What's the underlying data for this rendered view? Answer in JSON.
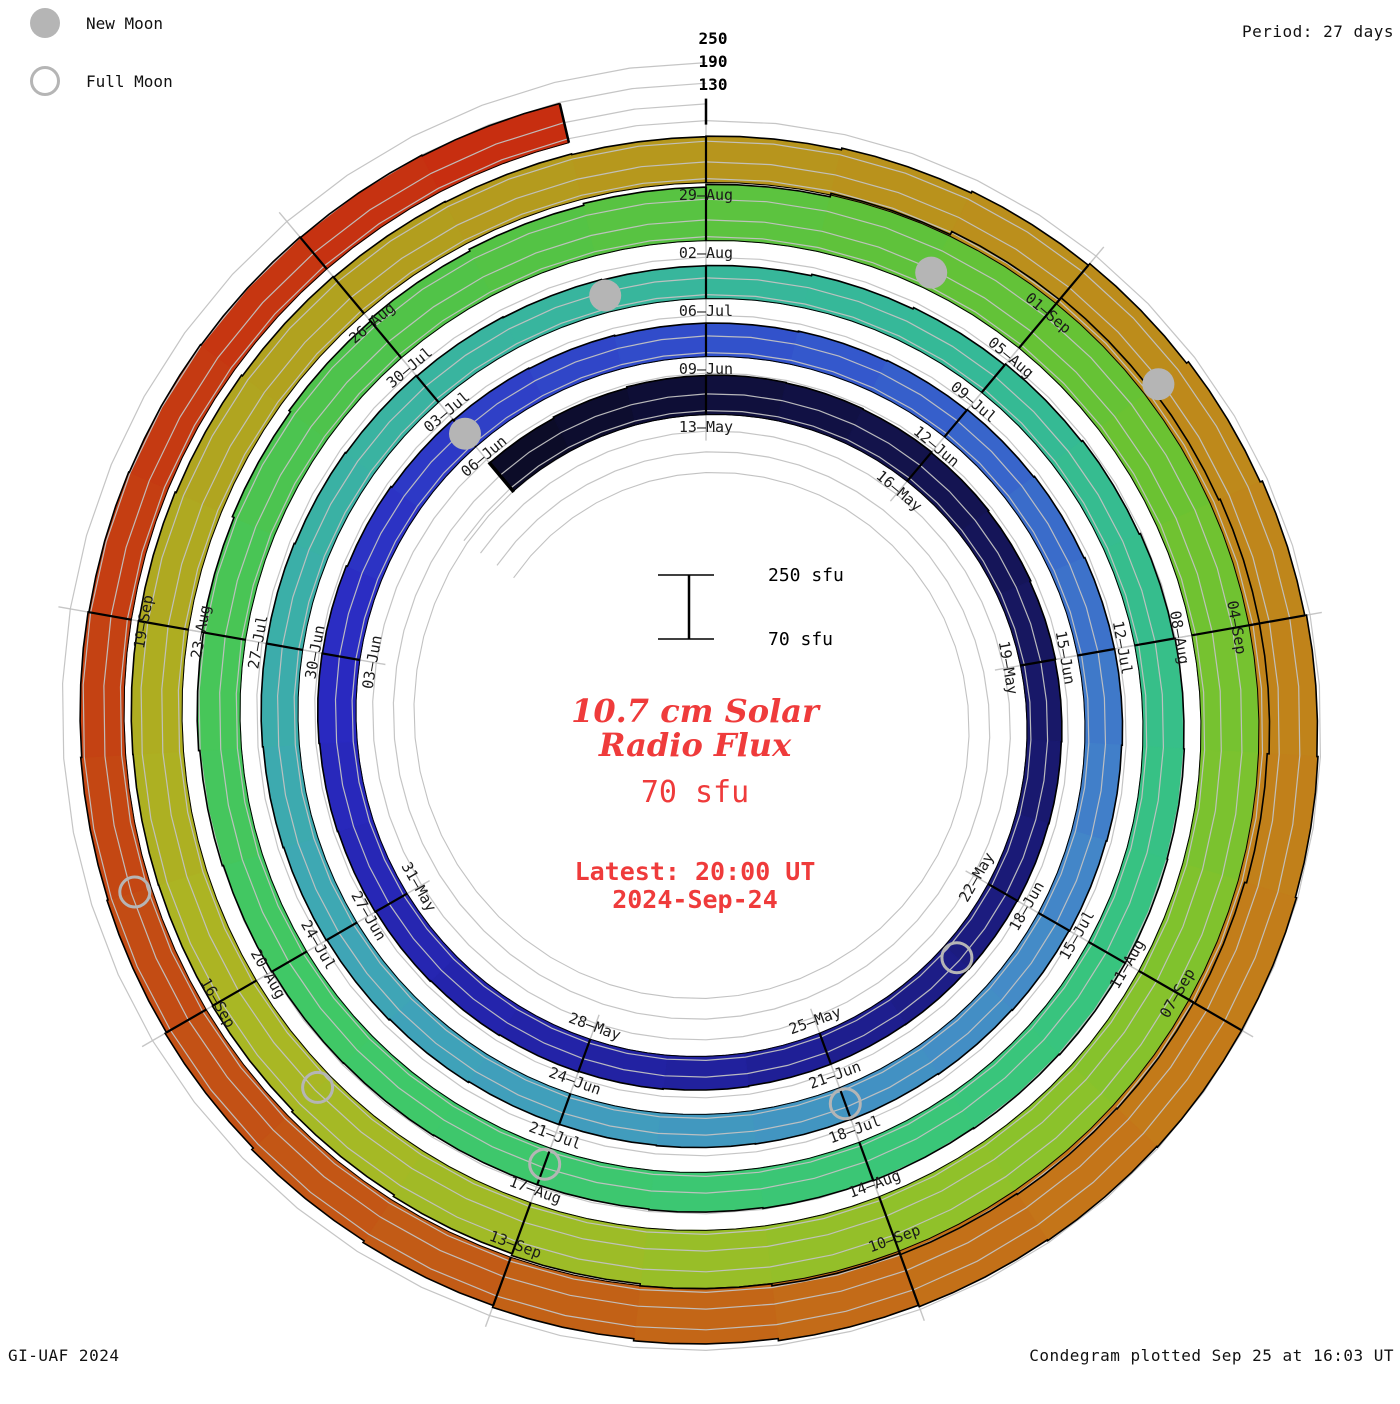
{
  "header": {
    "period": "Period: 27 days"
  },
  "legend": {
    "new_moon": "New Moon",
    "full_moon": "Full Moon"
  },
  "footer": {
    "left": "GI-UAF 2024",
    "right": "Condegram plotted Sep 25 at 16:03 UT"
  },
  "center": {
    "scale_top": "250 sfu",
    "scale_bottom": "70 sfu",
    "title_line1": "10.7 cm Solar",
    "title_line2": "Radio Flux",
    "current_flux": "70 sfu",
    "latest_line1": "Latest: 20:00 UT",
    "latest_line2": "2024-Sep-24",
    "accent_color": "#ef3b3b"
  },
  "chart_data": {
    "type": "bar",
    "layout": "polar_spiral_condegram",
    "title": "10.7 cm Solar Radio Flux",
    "ylabel": "solar flux (sfu)",
    "units": "sfu",
    "period_days_per_rotation": 27,
    "spiral_start_date": "2024-05-10",
    "first_label_date_at_top": "2024-05-13",
    "baseline_sfu": 70,
    "radial_ticks_sfu": [
      130,
      190,
      250
    ],
    "ylim": [
      70,
      250
    ],
    "points": [
      {
        "date": "2024-05-10",
        "flux": 175,
        "label": null
      },
      {
        "date": "2024-05-13",
        "flux": 185,
        "label": "13–May"
      },
      {
        "date": "2024-05-16",
        "flux": 180,
        "label": "16–May"
      },
      {
        "date": "2024-05-19",
        "flux": 172,
        "label": "19–May"
      },
      {
        "date": "2024-05-22",
        "flux": 168,
        "label": "22–May"
      },
      {
        "date": "2024-05-25",
        "flux": 165,
        "label": "25–May"
      },
      {
        "date": "2024-05-28",
        "flux": 170,
        "label": "28–May"
      },
      {
        "date": "2024-05-31",
        "flux": 176,
        "label": "31–May"
      },
      {
        "date": "2024-06-03",
        "flux": 182,
        "label": "03–Jun"
      },
      {
        "date": "2024-06-06",
        "flux": 172,
        "label": "06–Jun"
      },
      {
        "date": "2024-06-09",
        "flux": 166,
        "label": "09–Jun"
      },
      {
        "date": "2024-06-12",
        "flux": 172,
        "label": "12–Jun"
      },
      {
        "date": "2024-06-15",
        "flux": 180,
        "label": "15–Jun"
      },
      {
        "date": "2024-06-18",
        "flux": 174,
        "label": "18–Jun"
      },
      {
        "date": "2024-06-21",
        "flux": 168,
        "label": "21–Jun"
      },
      {
        "date": "2024-06-24",
        "flux": 164,
        "label": "24–Jun"
      },
      {
        "date": "2024-06-27",
        "flux": 172,
        "label": "27–Jun"
      },
      {
        "date": "2024-06-30",
        "flux": 178,
        "label": "30–Jun"
      },
      {
        "date": "2024-07-03",
        "flux": 170,
        "label": "03–Jul"
      },
      {
        "date": "2024-07-06",
        "flux": 164,
        "label": "06–Jul"
      },
      {
        "date": "2024-07-09",
        "flux": 176,
        "label": "09–Jul"
      },
      {
        "date": "2024-07-12",
        "flux": 188,
        "label": "12–Jul"
      },
      {
        "date": "2024-07-15",
        "flux": 194,
        "label": "15–Jul"
      },
      {
        "date": "2024-07-18",
        "flux": 188,
        "label": "18–Jul"
      },
      {
        "date": "2024-07-21",
        "flux": 182,
        "label": "21–Jul"
      },
      {
        "date": "2024-07-24",
        "flux": 186,
        "label": "24–Jul"
      },
      {
        "date": "2024-07-27",
        "flux": 196,
        "label": "27–Jul"
      },
      {
        "date": "2024-07-30",
        "flux": 212,
        "label": "30–Jul"
      },
      {
        "date": "2024-08-02",
        "flux": 228,
        "label": "02–Aug"
      },
      {
        "date": "2024-08-05",
        "flux": 258,
        "label": "05–Aug"
      },
      {
        "date": "2024-08-08",
        "flux": 272,
        "label": "08–Aug"
      },
      {
        "date": "2024-08-11",
        "flux": 255,
        "label": "11–Aug"
      },
      {
        "date": "2024-08-14",
        "flux": 248,
        "label": "14–Aug"
      },
      {
        "date": "2024-08-17",
        "flux": 230,
        "label": "17–Aug"
      },
      {
        "date": "2024-08-20",
        "flux": 215,
        "label": "20–Aug"
      },
      {
        "date": "2024-08-23",
        "flux": 218,
        "label": "23–Aug"
      },
      {
        "date": "2024-08-26",
        "flux": 208,
        "label": "26–Aug"
      },
      {
        "date": "2024-08-29",
        "flux": 202,
        "label": "29–Aug"
      },
      {
        "date": "2024-09-01",
        "flux": 218,
        "label": "01–Sep"
      },
      {
        "date": "2024-09-04",
        "flux": 238,
        "label": "04–Sep"
      },
      {
        "date": "2024-09-07",
        "flux": 248,
        "label": "07–Sep"
      },
      {
        "date": "2024-09-10",
        "flux": 240,
        "label": "10–Sep"
      },
      {
        "date": "2024-09-13",
        "flux": 222,
        "label": "13–Sep"
      },
      {
        "date": "2024-09-16",
        "flux": 205,
        "label": "16–Sep"
      },
      {
        "date": "2024-09-19",
        "flux": 196,
        "label": "19–Sep"
      },
      {
        "date": "2024-09-22",
        "flux": 190,
        "label": null
      },
      {
        "date": "2024-09-24",
        "flux": 186,
        "label": null
      }
    ],
    "new_moons": [
      "2024-06-06",
      "2024-07-05",
      "2024-08-04",
      "2024-09-02"
    ],
    "full_moons": [
      "2024-05-23",
      "2024-06-21",
      "2024-07-21",
      "2024-08-19",
      "2024-09-17"
    ],
    "colors": {
      "gradient_day_stops": [
        [
          0,
          "#0b0b24"
        ],
        [
          8,
          "#16165c"
        ],
        [
          16,
          "#20209a"
        ],
        [
          24,
          "#2a2ac2"
        ],
        [
          31,
          "#3355cc"
        ],
        [
          39,
          "#4489c8"
        ],
        [
          47,
          "#3fa4b8"
        ],
        [
          53,
          "#3ab2a2"
        ],
        [
          60,
          "#35b996"
        ],
        [
          67,
          "#38c57c"
        ],
        [
          74,
          "#3fc868"
        ],
        [
          81,
          "#4fc34a"
        ],
        [
          88,
          "#68c233"
        ],
        [
          95,
          "#8ec22a"
        ],
        [
          102,
          "#abb623"
        ],
        [
          109,
          "#b39c1e"
        ],
        [
          115,
          "#bd8a1b"
        ],
        [
          121,
          "#c47819"
        ],
        [
          126,
          "#c25e16"
        ],
        [
          131,
          "#c44413"
        ],
        [
          137,
          "#c72c10"
        ]
      ],
      "grid": "#c2c2c2",
      "tick": "#c6c6c6",
      "edge": "#000000",
      "moon": "#b5b5b5",
      "label_text": "#1a1a1a"
    }
  }
}
